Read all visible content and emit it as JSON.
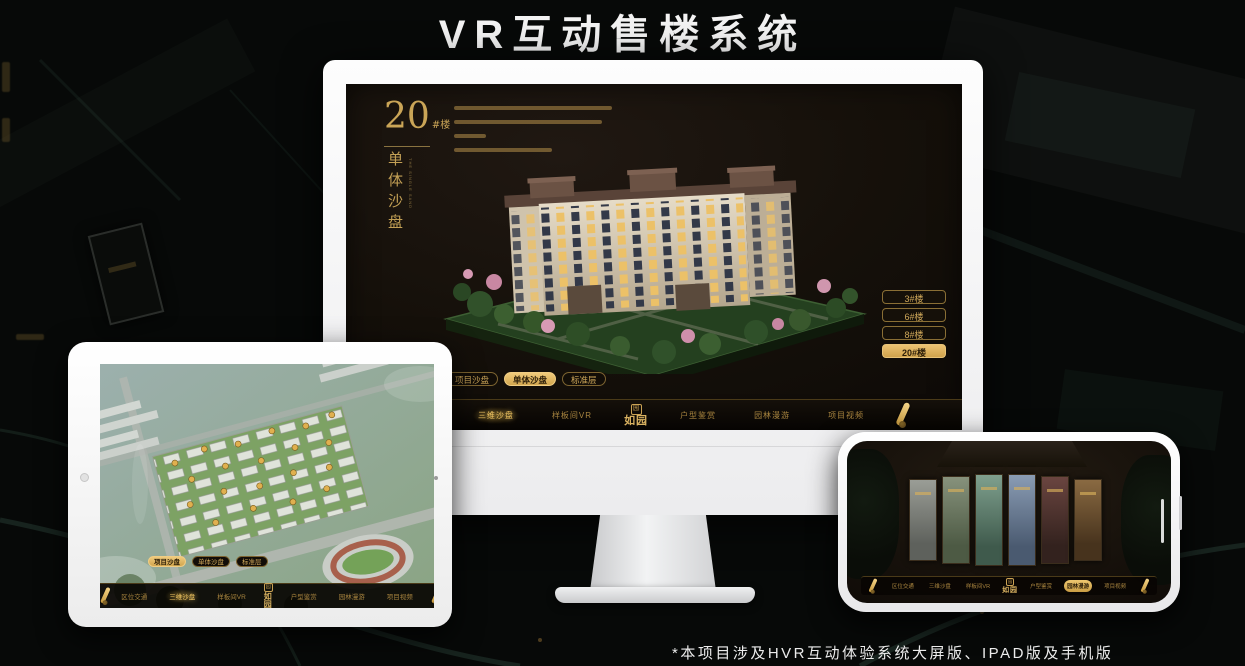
{
  "title": "VR互动售楼系统",
  "footnote": "*本项目涉及HVR互动体验系统大屏版、IPAD版及手机版",
  "colors": {
    "gold": "#c9a253",
    "gold_bright": "#f0ca7c",
    "screen_bg": "#15100a",
    "monitor_body": "#fdfdfd"
  },
  "header_panel": {
    "number": "20",
    "suffix": "#楼",
    "vertical_title": "单体沙盘",
    "vertical_sub": "THE SINGLE SAND"
  },
  "floor_buttons": [
    {
      "label": "3#楼",
      "active": false
    },
    {
      "label": "6#楼",
      "active": false
    },
    {
      "label": "8#楼",
      "active": false
    },
    {
      "label": "20#楼",
      "active": true
    }
  ],
  "tabs": [
    {
      "label": "项目沙盘"
    },
    {
      "label": "单体沙盘"
    },
    {
      "label": "标准层"
    }
  ],
  "nav": {
    "items": [
      {
        "label": "区位交通"
      },
      {
        "label": "三维沙盘"
      },
      {
        "label": "样板间VR"
      },
      {
        "label": "户型鉴赏"
      },
      {
        "label": "园林漫游"
      },
      {
        "label": "项目视频"
      }
    ],
    "logo": "如园",
    "logo_seal": "园"
  },
  "phone_gallery": {
    "panel_count": 6
  },
  "icons": {
    "scroll": "rolled-scroll",
    "seal": "square-seal",
    "camera": "front-camera-dot"
  }
}
